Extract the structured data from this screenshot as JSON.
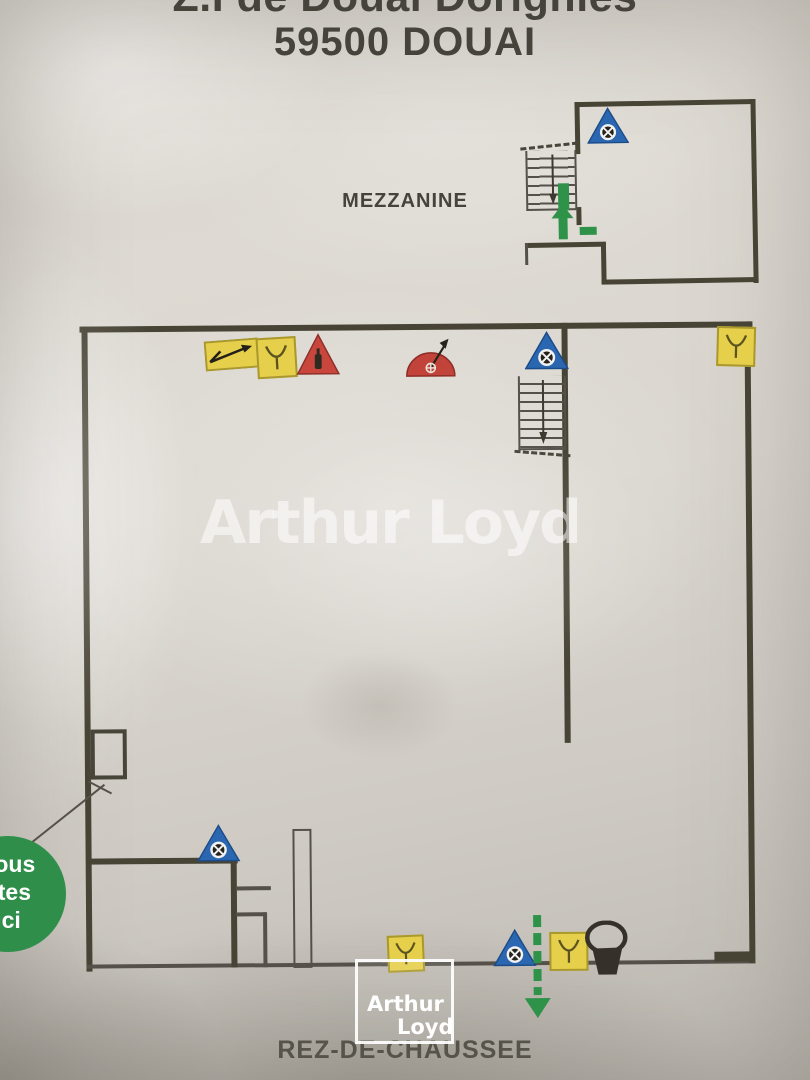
{
  "header": {
    "line1": "Z.I de Douai Dorignies",
    "line2": "59500 DOUAI"
  },
  "floors": {
    "mezzanine_label": "MEZZANINE",
    "ground_label": "REZ-DE-CHAUSSEE"
  },
  "watermark_text": "Arthur Loyd",
  "logo": {
    "line1": "Arthur",
    "line2": "Loyd"
  },
  "you_are_here": {
    "line1": "Vous",
    "line2": "êtes",
    "line3": "ici"
  },
  "colors": {
    "wall": "#474335",
    "safety_yellow": "#e6cf4b",
    "safety_red": "#c9463c",
    "safety_blue": "#2a67b0",
    "accent_green": "#2f9249",
    "text": "#45433a",
    "watermark": "rgba(255,255,255,0.55)"
  },
  "icons": {
    "alarm_call_point": "blue-triangle-alarm-icon",
    "extinguisher": "red-triangle-extinguisher-icon",
    "hose_reel": "red-semicircle-hose-reel-icon",
    "shutoff_valve": "yellow-square-valve-icon",
    "electrical_cutoff": "yellow-rect-electric-arrow-icon",
    "sand_bucket": "black-bucket-icon",
    "evacuation_exit_arrow": "green-dashed-arrow-icon",
    "evacuation_up_arrow": "green-solid-arrow-icon",
    "stairs": "stairs-icon"
  }
}
